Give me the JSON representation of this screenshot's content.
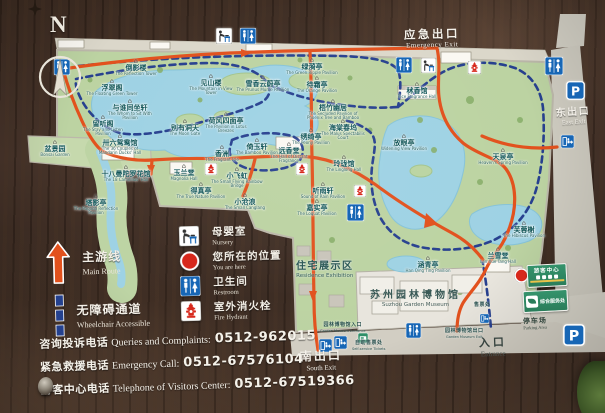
{
  "colors": {
    "wood": "#42302​4",
    "panel": "#dbd7ca",
    "land": "#bcd3a2",
    "water": "#9ed2e4",
    "route_main": "#e2511d",
    "route_accessible": "#27408f",
    "label_text": "#14585a",
    "icon_blue": "#1766b5",
    "marker_red": "#d7281c",
    "sign_green": "#2f8f68"
  },
  "compass": {
    "letter": "N"
  },
  "board_labels": {
    "emergency_exit": {
      "zh": "应急出口",
      "en": "Emergency Exit"
    },
    "east_exit": {
      "zh": "东出口",
      "en": "East Exit"
    },
    "south_exit": {
      "zh": "南出口",
      "en": "South Exit"
    },
    "entrance": {
      "zh": "入口",
      "en": "Entrance"
    },
    "parking_area": {
      "zh": "停车场",
      "en": "Parking Area"
    },
    "residence_exhibition": {
      "zh": "住宅展示区",
      "en": "Residence Exhibition"
    },
    "garden_museum": {
      "zh": "苏州园林博物馆",
      "en": "Suzhou Garden Museum"
    },
    "museum_entrance": {
      "zh": "园林博物馆入口",
      "en": "Garden Museum Entrance"
    },
    "museum_exit": {
      "zh": "园林博物馆出口",
      "en": "Garden Museum Exit"
    },
    "self_ticket": {
      "zh": "自助售票处",
      "en": "Self-service Tickets"
    },
    "ticket_office": {
      "zh": "售票处",
      "en": ""
    },
    "visitor_center": {
      "zh": "游客中心"
    },
    "service_center": {
      "zh": "综合服务处"
    }
  },
  "map_labels": [
    {
      "zh": "倒影楼",
      "en": "The Reflection Tower",
      "x": 136,
      "y": 67
    },
    {
      "zh": "见山楼",
      "en": "The Mountain in View Tower",
      "x": 211,
      "y": 82
    },
    {
      "zh": "浮翠阁",
      "en": "The Floating Green Tower",
      "x": 112,
      "y": 87
    },
    {
      "zh": "与谁同坐轩",
      "en": "The Whom to Sit With Pavilion",
      "x": 130,
      "y": 107
    },
    {
      "zh": "留听阁",
      "en": "The Stay and Listen Pavilion",
      "x": 103,
      "y": 123
    },
    {
      "zh": "别有洞天",
      "en": "The Moon Gate",
      "x": 185,
      "y": 127
    },
    {
      "zh": "卅六鸳鸯馆",
      "en": "The 36 Couples of Mandarin Ducks' Hall",
      "x": 120,
      "y": 142
    },
    {
      "zh": "十八曼陀罗花馆",
      "en": "The 18 Camellias' Hall",
      "x": 126,
      "y": 173
    },
    {
      "zh": "塔影亭",
      "en": "The Pagoda Reflection Pavilion",
      "x": 96,
      "y": 202
    },
    {
      "zh": "盆景园",
      "en": "Bonsai Garden",
      "x": 55,
      "y": 148
    },
    {
      "zh": "荷风四面亭",
      "en": "The Pavilion in Lotus Breezes",
      "x": 226,
      "y": 120
    },
    {
      "zh": "雪香云蔚亭",
      "en": "The Prunus Mume Pavilion",
      "x": 263,
      "y": 83
    },
    {
      "zh": "绿漪亭",
      "en": "The Green Ripple Pavilion",
      "x": 312,
      "y": 66
    },
    {
      "zh": "待霜亭",
      "en": "The Orange Pavilion",
      "x": 317,
      "y": 84
    },
    {
      "zh": "梧竹幽居",
      "en": "The Secluded Pavilion of Phoenix Tree and Bamboo",
      "x": 333,
      "y": 107
    },
    {
      "zh": "海棠春坞",
      "en": "The Malus Spectabilis Court",
      "x": 343,
      "y": 127
    },
    {
      "zh": "绣绮亭",
      "en": "The Peony Pavilion",
      "x": 311,
      "y": 136
    },
    {
      "zh": "远香堂",
      "en": "The Hall of Distant Fragrance",
      "x": 289,
      "y": 150
    },
    {
      "zh": "倚玉轩",
      "en": "The Bamboo Pavilion",
      "x": 257,
      "y": 146
    },
    {
      "zh": "香洲",
      "en": "The Fragrant Isle",
      "x": 222,
      "y": 153
    },
    {
      "zh": "玉兰堂",
      "en": "Magnolia Hall",
      "x": 184,
      "y": 172
    },
    {
      "zh": "小飞虹",
      "en": "The Small Flying Rainbow Bridge",
      "x": 237,
      "y": 175
    },
    {
      "zh": "得真亭",
      "en": "The True Nature Pavilion",
      "x": 201,
      "y": 190
    },
    {
      "zh": "小沧浪",
      "en": "The Small Canglang",
      "x": 245,
      "y": 201
    },
    {
      "zh": "玲珑馆",
      "en": "The Linglong Hall",
      "x": 344,
      "y": 163
    },
    {
      "zh": "听雨轩",
      "en": "Sound of Rain Pavilion",
      "x": 323,
      "y": 190
    },
    {
      "zh": "嘉实亭",
      "en": "The Loquat Pavilion",
      "x": 317,
      "y": 207
    },
    {
      "zh": "放眼亭",
      "en": "Widening View Pavilion",
      "x": 404,
      "y": 142
    },
    {
      "zh": "秫香馆",
      "en": "Rice Fragrance Hall",
      "x": 417,
      "y": 90
    },
    {
      "zh": "天泉亭",
      "en": "Heaven's Spring Pavilion",
      "x": 503,
      "y": 156
    },
    {
      "zh": "芙蓉榭",
      "en": "The Hibiscus Pavilion",
      "x": 524,
      "y": 229
    },
    {
      "zh": "兰雪堂",
      "en": "Lan Xue Tang Hall",
      "x": 498,
      "y": 255
    },
    {
      "zh": "涵青亭",
      "en": "Han Qing Ting Pavilion",
      "x": 428,
      "y": 264
    }
  ],
  "map_icons": [
    {
      "type": "restroom",
      "x": 54,
      "y": 59,
      "s": 16
    },
    {
      "type": "nursery",
      "x": 216,
      "y": 28,
      "s": 16
    },
    {
      "type": "restroom",
      "x": 240,
      "y": 28,
      "s": 16
    },
    {
      "type": "restroom",
      "x": 396,
      "y": 57,
      "s": 16
    },
    {
      "type": "nursery",
      "x": 421,
      "y": 58,
      "s": 15
    },
    {
      "type": "fire-hydrant",
      "x": 468,
      "y": 61,
      "s": 13
    },
    {
      "type": "restroom",
      "x": 545,
      "y": 57,
      "s": 18
    },
    {
      "type": "parking",
      "x": 566,
      "y": 81,
      "s": 19
    },
    {
      "type": "exit",
      "x": 561,
      "y": 135,
      "s": 13
    },
    {
      "type": "fire-hydrant",
      "x": 205,
      "y": 163,
      "s": 12
    },
    {
      "type": "fire-hydrant",
      "x": 296,
      "y": 163,
      "s": 12
    },
    {
      "type": "fire-hydrant",
      "x": 354,
      "y": 185,
      "s": 12
    },
    {
      "type": "restroom",
      "x": 347,
      "y": 204,
      "s": 17
    },
    {
      "type": "restroom",
      "x": 406,
      "y": 323,
      "s": 15
    },
    {
      "type": "exit",
      "x": 319,
      "y": 339,
      "s": 13
    },
    {
      "type": "exit",
      "x": 334,
      "y": 336,
      "s": 13
    },
    {
      "type": "ticket",
      "x": 358,
      "y": 333,
      "s": 10
    },
    {
      "type": "exit",
      "x": 480,
      "y": 314,
      "s": 9
    },
    {
      "type": "parking",
      "x": 563,
      "y": 324,
      "s": 22
    },
    {
      "type": "you-are-here",
      "x": 514,
      "y": 268,
      "s": 15
    }
  ],
  "legend": {
    "routes": [
      {
        "icon": "main-route",
        "zh": "主游线",
        "en": "Main Route"
      },
      {
        "icon": "accessible-route",
        "zh": "无障碍通道",
        "en": "Wheelchair Accessible"
      }
    ],
    "facilities": [
      {
        "icon": "nursery",
        "zh": "母婴室",
        "en": "Nursery"
      },
      {
        "icon": "you-are-here",
        "zh": "您所在的位置",
        "en": "You are here"
      },
      {
        "icon": "restroom",
        "zh": "卫生间",
        "en": "Restroom"
      },
      {
        "icon": "fire-hydrant",
        "zh": "室外消火栓",
        "en": "Fire Hydrant"
      }
    ],
    "phones": [
      {
        "zh": "咨询投诉电话",
        "en": "Queries and Complaints:",
        "number": "0512-962015"
      },
      {
        "zh": "紧急救援电话",
        "en": "Emergency Call:",
        "number": "0512-67576104"
      },
      {
        "zh": "游客中心电话",
        "en": "Telephone of Visitors Center:",
        "number": "0512-67519366"
      }
    ]
  }
}
